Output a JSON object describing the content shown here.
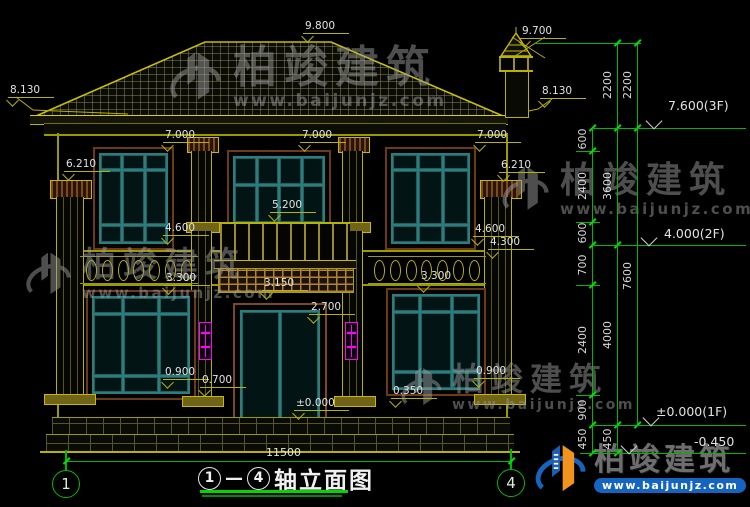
{
  "drawing": {
    "title": {
      "axis_from": "1",
      "axis_to": "4",
      "separator": "—",
      "text": "轴立面图"
    },
    "axis_bubbles": {
      "left": "1",
      "right": "4"
    },
    "overall_dim": "11500",
    "elevation_marks": [
      {
        "text": "9.800",
        "x": 303,
        "y": 20
      },
      {
        "text": "9.700",
        "x": 520,
        "y": 25
      },
      {
        "text": "8.130",
        "x": 8,
        "y": 84
      },
      {
        "text": "8.130",
        "x": 540,
        "y": 85
      },
      {
        "text": "7.000",
        "x": 163,
        "y": 129
      },
      {
        "text": "7.000",
        "x": 300,
        "y": 129
      },
      {
        "text": "7.000",
        "x": 475,
        "y": 129
      },
      {
        "text": "6.210",
        "x": 64,
        "y": 158
      },
      {
        "text": "6.210",
        "x": 499,
        "y": 159
      },
      {
        "text": "5.200",
        "x": 270,
        "y": 199
      },
      {
        "text": "4.600",
        "x": 163,
        "y": 222
      },
      {
        "text": "4.600",
        "x": 473,
        "y": 223
      },
      {
        "text": "4.300",
        "x": 488,
        "y": 236
      },
      {
        "text": "3.300",
        "x": 164,
        "y": 272
      },
      {
        "text": "3.300",
        "x": 419,
        "y": 270
      },
      {
        "text": "3.150",
        "x": 262,
        "y": 277
      },
      {
        "text": "2.700",
        "x": 309,
        "y": 301
      },
      {
        "text": "0.900",
        "x": 163,
        "y": 366
      },
      {
        "text": "0.700",
        "x": 200,
        "y": 374
      },
      {
        "text": "0.900",
        "x": 474,
        "y": 365
      },
      {
        "text": "0.350",
        "x": 391,
        "y": 385
      },
      {
        "text": "±0.000",
        "x": 294,
        "y": 397
      }
    ],
    "level_flags": [
      {
        "text": "7.600(3F)",
        "x": 668,
        "y": 98,
        "line_y": 128,
        "line_x1": 592,
        "line_x2": 746,
        "tri_x": 655
      },
      {
        "text": "4.000(2F)",
        "x": 664,
        "y": 226,
        "line_y": 245,
        "line_x1": 592,
        "line_x2": 746,
        "tri_x": 650
      },
      {
        "text": "±0.000(1F)",
        "x": 656,
        "y": 404,
        "line_y": 425,
        "line_x1": 592,
        "line_x2": 746,
        "tri_x": 652
      },
      {
        "text": "-0.450",
        "x": 694,
        "y": 434,
        "line_y": 453,
        "line_x1": 580,
        "line_x2": 746,
        "tri_x": 630
      }
    ],
    "dim_chains": [
      {
        "x": 592,
        "y1": 128,
        "y2": 453,
        "ticks": [
          128,
          151,
          222,
          245,
          285,
          395,
          425,
          453
        ],
        "segments": [
          {
            "label": "600",
            "mid": 139
          },
          {
            "label": "2400",
            "mid": 186
          },
          {
            "label": "600",
            "mid": 233
          },
          {
            "label": "700",
            "mid": 265
          },
          {
            "label": "2400",
            "mid": 340
          },
          {
            "label": "900",
            "mid": 410
          },
          {
            "label": "450",
            "mid": 439
          }
        ]
      },
      {
        "x": 617,
        "y1": 43,
        "y2": 453,
        "ticks": [
          43,
          128,
          245,
          425,
          453
        ],
        "segments": [
          {
            "label": "2200",
            "mid": 85
          },
          {
            "label": "3600",
            "mid": 186
          },
          {
            "label": "4000",
            "mid": 335
          },
          {
            "label": "450",
            "mid": 439
          }
        ]
      },
      {
        "x": 637,
        "y1": 43,
        "y2": 425,
        "ticks": [
          43,
          128,
          425
        ],
        "segments": [
          {
            "label": "2200",
            "mid": 85
          },
          {
            "label": "7600",
            "mid": 276
          }
        ]
      }
    ],
    "ext_lines": [
      {
        "y": 43,
        "x1": 535,
        "x2": 641
      },
      {
        "y": 151,
        "x1": 576,
        "x2": 600
      },
      {
        "y": 222,
        "x1": 576,
        "x2": 600
      },
      {
        "y": 285,
        "x1": 576,
        "x2": 600
      },
      {
        "y": 395,
        "x1": 576,
        "x2": 600
      }
    ]
  },
  "watermark": {
    "name": "柏竣建筑",
    "url": "www.baijunjz.com"
  },
  "logo": {
    "name": "柏竣建筑",
    "url": "www.baijunjz.com"
  },
  "colors": {
    "background": "#000000",
    "dim_green": "#00c800",
    "line_yellow": "#b8b200",
    "bright_yellow": "#d8d000",
    "window_teal": "#2e7d7d",
    "frame_brown": "#6b3a16",
    "lamp_magenta": "#ff00ff",
    "label_text": "#e2e2e2",
    "logo_blue": "#1565c0",
    "logo_orange": "#f0941d"
  }
}
